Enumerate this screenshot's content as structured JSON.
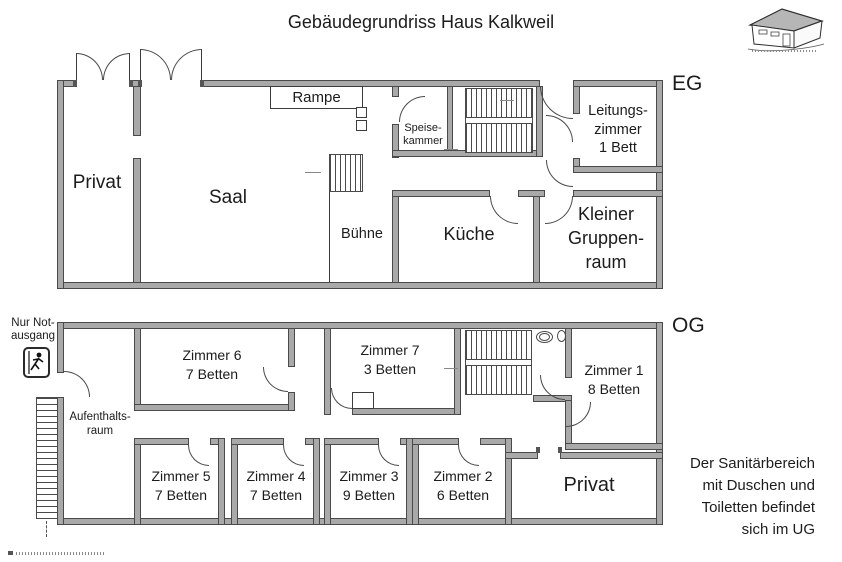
{
  "title": "Gebäudegrundriss Haus Kalkweil",
  "eg": {
    "floor_label": "EG",
    "rooms": {
      "privat": "Privat",
      "saal": "Saal",
      "rampe": "Rampe",
      "buehne": "Bühne",
      "speisekammer": "Speise-\nkammer",
      "kueche": "Küche",
      "leitungszimmer": "Leitungs-\nzimmer\n1 Bett",
      "kleiner_gruppenraum": "Kleiner\nGruppen-\nraum"
    }
  },
  "og": {
    "floor_label": "OG",
    "emergency_exit_note": "Nur Not-\nausgang",
    "rooms": {
      "aufenthaltsraum": "Aufenthalts-\nraum",
      "zimmer6": "Zimmer 6\n7 Betten",
      "zimmer7": "Zimmer 7\n3 Betten",
      "zimmer1": "Zimmer 1\n8 Betten",
      "zimmer5": "Zimmer 5\n7 Betten",
      "zimmer4": "Zimmer 4\n7 Betten",
      "zimmer3": "Zimmer 3\n9 Betten",
      "zimmer2": "Zimmer 2\n6 Betten",
      "privat": "Privat"
    }
  },
  "sanitary_note": "Der Sanitärbereich\nmit Duschen und\nToiletten befindet\nsich im UG",
  "colors": {
    "wall_fill": "#a9a9a9",
    "wall_edge": "#4a4a4a",
    "roof_fill": "#b6b6b6"
  }
}
